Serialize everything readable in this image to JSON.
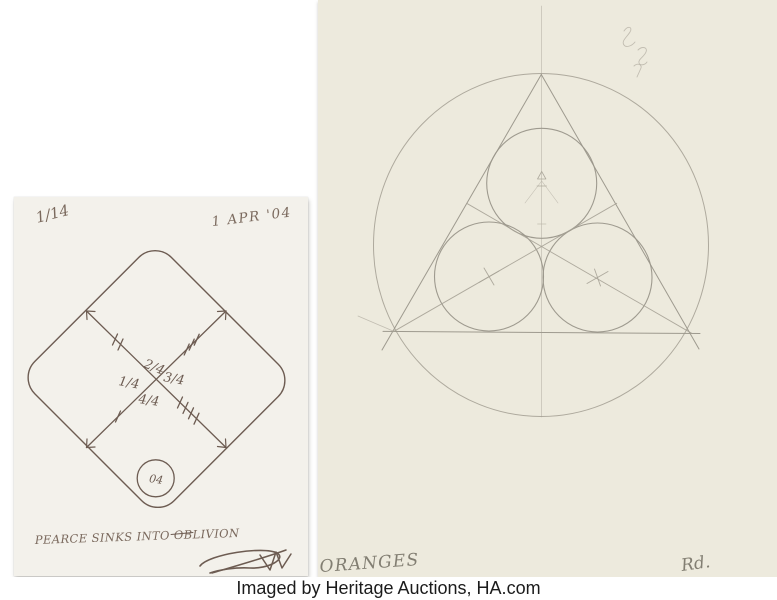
{
  "photo": {
    "caption": "Imaged by Heritage Auctions, HA.com"
  },
  "left_sheet": {
    "description": "Ink drawing: rounded diamond with crossed diagonals, tally marks, quarter fractions and a small circle",
    "edition": "1/14",
    "date": "1 APR '04",
    "fractions": {
      "top": "2/4",
      "left": "1/4",
      "right": "3/4",
      "bottom": "4/4"
    },
    "tally_marks": {
      "upper_left": 2,
      "upper_right": 3,
      "lower_left": 1,
      "lower_right": 4
    },
    "circle_label": "04",
    "inscription": "PEARCE SINKS INTO OBLIVION",
    "paper_color": "#f3f1eb",
    "ink_color": "#6d5c52"
  },
  "right_sheet": {
    "description": "Pencil drawing: three mutually tangent circles inside a triangle inscribed in a large circle",
    "title": "ORANGES",
    "signature": "Rd.",
    "paper_color": "#edeadd",
    "pencil_color": "#a6a296"
  }
}
